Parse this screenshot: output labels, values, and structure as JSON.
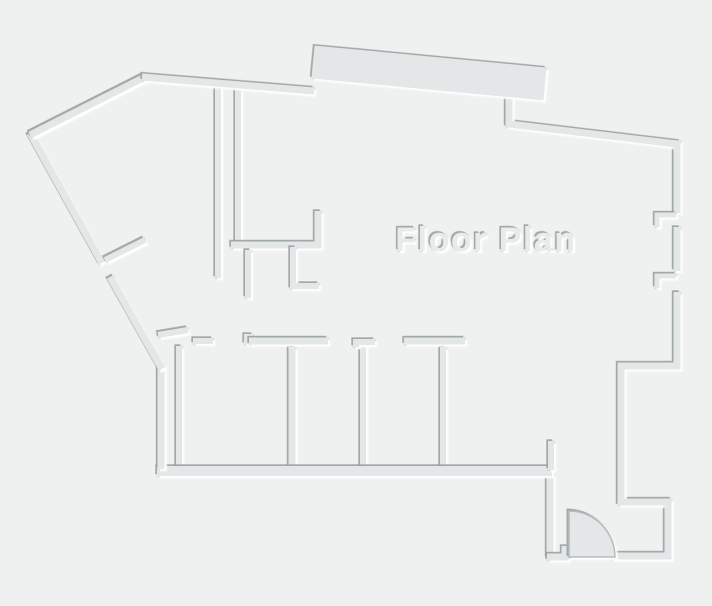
{
  "title": "Floor Plan",
  "canvas": {
    "width": 712,
    "height": 606,
    "background": "#eff1f1"
  },
  "palette": {
    "wall_fill": "#e3e7e7",
    "edge_dark": "#9aa1a1",
    "edge_light": "#ffffff",
    "text_fill": "#e8ebeb",
    "arc_stroke": "#b3bbbb"
  },
  "title_style": {
    "x": 486,
    "y": 251,
    "font_size": 34,
    "letter_spacing": 1.5
  },
  "walls": [
    {
      "name": "corridor-wall-left",
      "points": [
        [
          218,
          82
        ],
        [
          218,
          278
        ]
      ],
      "width": 6
    },
    {
      "name": "corridor-wall-right",
      "points": [
        [
          238,
          85
        ],
        [
          238,
          246
        ]
      ],
      "width": 6
    },
    {
      "name": "mid-wall-with-return",
      "points": [
        [
          231,
          245
        ],
        [
          318,
          245
        ],
        [
          318,
          211
        ]
      ],
      "width": 7
    },
    {
      "name": "closet-partition-1",
      "points": [
        [
          248,
          250
        ],
        [
          248,
          298
        ]
      ],
      "width": 6
    },
    {
      "name": "closet-partition-2",
      "points": [
        [
          293,
          247
        ],
        [
          293,
          286
        ],
        [
          319,
          286
        ]
      ],
      "width": 6
    },
    {
      "name": "room-partition-a",
      "points": [
        [
          179,
          346
        ],
        [
          179,
          468
        ]
      ],
      "width": 6
    },
    {
      "name": "room-partition-b",
      "points": [
        [
          292,
          347
        ],
        [
          292,
          468
        ]
      ],
      "width": 7
    },
    {
      "name": "room-partition-c",
      "points": [
        [
          363,
          344
        ],
        [
          363,
          468
        ]
      ],
      "width": 6
    },
    {
      "name": "room-partition-d",
      "points": [
        [
          443,
          347
        ],
        [
          443,
          468
        ]
      ],
      "width": 6
    },
    {
      "name": "entry-jamb-lower",
      "points": [
        [
          550,
          474
        ],
        [
          550,
          558
        ]
      ],
      "width": 7
    },
    {
      "name": "room-top-dash",
      "points": [
        [
          193,
          341
        ],
        [
          213,
          341
        ]
      ],
      "width": 6
    },
    {
      "name": "room-top-nub",
      "points": [
        [
          247,
          344
        ],
        [
          247,
          337
        ],
        [
          253,
          337
        ]
      ],
      "width": 6
    },
    {
      "name": "room-top-run",
      "points": [
        [
          249,
          341
        ],
        [
          328,
          341
        ]
      ],
      "width": 7
    },
    {
      "name": "room-top-corner",
      "points": [
        [
          356,
          347
        ],
        [
          356,
          342
        ],
        [
          375,
          342
        ]
      ],
      "width": 6
    },
    {
      "name": "room-top-header",
      "points": [
        [
          404,
          341
        ],
        [
          465,
          341
        ]
      ],
      "width": 7
    },
    {
      "name": "doorway-stub-lower-left",
      "points": [
        [
          158,
          335
        ],
        [
          188,
          330
        ]
      ],
      "width": 6
    },
    {
      "name": "bottom-exterior-wall",
      "points": [
        [
          157,
          471
        ],
        [
          552,
          471
        ]
      ],
      "width": 10
    },
    {
      "name": "left-exterior-wall-vertical",
      "points": [
        [
          161,
          364
        ],
        [
          161,
          469
        ]
      ],
      "width": 7
    },
    {
      "name": "left-exterior-diagonal-upper",
      "points": [
        [
          30,
          133
        ],
        [
          102,
          263
        ]
      ],
      "width": 7
    },
    {
      "name": "left-exterior-diagonal-lower",
      "points": [
        [
          110,
          277
        ],
        [
          162,
          369
        ]
      ],
      "width": 7
    },
    {
      "name": "doorway-stub-left",
      "points": [
        [
          105,
          260
        ],
        [
          145,
          240
        ]
      ],
      "width": 6
    },
    {
      "name": "top-left-diagonal-wall",
      "points": [
        [
          30,
          135
        ],
        [
          145,
          77
        ]
      ],
      "width": 7
    },
    {
      "name": "top-wall",
      "points": [
        [
          142,
          77
        ],
        [
          314,
          91
        ]
      ],
      "width": 7
    },
    {
      "name": "top-right-exterior-wall",
      "points": [
        [
          509,
          94
        ],
        [
          509,
          124
        ],
        [
          677,
          144
        ],
        [
          677,
          213
        ]
      ],
      "width": 7
    },
    {
      "name": "top-band-wall",
      "points": [
        [
          313,
          62
        ],
        [
          545,
          84
        ]
      ],
      "width": 33
    },
    {
      "name": "window-bracket-upper",
      "points": [
        [
          676,
          215
        ],
        [
          657,
          215
        ],
        [
          657,
          227
        ]
      ],
      "width": 5
    },
    {
      "name": "right-wall-mid-segment",
      "points": [
        [
          677,
          227
        ],
        [
          677,
          271
        ]
      ],
      "width": 7
    },
    {
      "name": "window-bracket-lower",
      "points": [
        [
          676,
          276
        ],
        [
          657,
          276
        ],
        [
          657,
          288
        ]
      ],
      "width": 5
    },
    {
      "name": "entry-jamb-upper",
      "points": [
        [
          551,
          441
        ],
        [
          551,
          470
        ]
      ],
      "width": 6
    },
    {
      "name": "entry-bottom-left-wall",
      "points": [
        [
          547,
          557
        ],
        [
          565,
          557
        ],
        [
          565,
          546
        ]
      ],
      "width": 7
    },
    {
      "name": "lower-right-exterior-wall",
      "points": [
        [
          611,
          556
        ],
        [
          668,
          556
        ],
        [
          668,
          502
        ],
        [
          621,
          502
        ],
        [
          621,
          366
        ],
        [
          677,
          366
        ],
        [
          677,
          292
        ]
      ],
      "width": 7
    }
  ],
  "door": {
    "pivot_x": 569,
    "pivot_y": 557,
    "radius": 46
  }
}
